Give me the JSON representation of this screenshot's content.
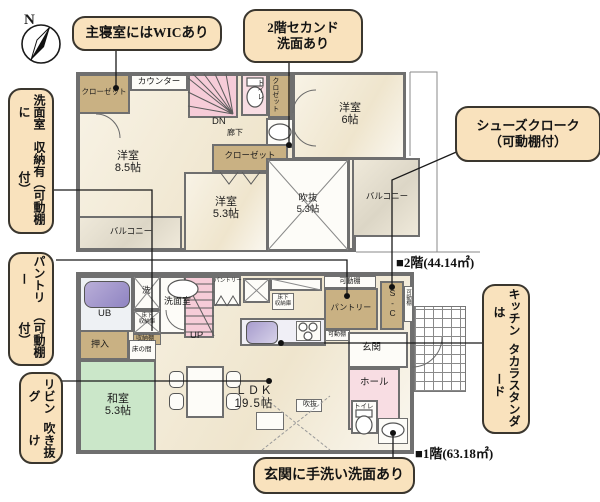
{
  "compass": {
    "north": "N"
  },
  "callouts": {
    "wic": "主寝室にはWICあり",
    "second_wash_1": "2階セカンド",
    "second_wash_2": "洗面あり",
    "washroom_storage_1": "洗面室に",
    "washroom_storage_2": "収納有（可動棚付）",
    "shoes_1": "シューズクローク",
    "shoes_2": "（可動棚付）",
    "pantry_1": "パントリー",
    "pantry_2": "（可動棚付）",
    "living_void_1": "リビング",
    "living_void_2": "吹き抜け",
    "kitchen_1": "キッチンは",
    "kitchen_2": "タカラスタンダード",
    "entrance_wash": "玄関に手洗い洗面あり"
  },
  "areas": {
    "f2": "■2階(44.14㎡)",
    "f1": "■1階(63.18㎡)"
  },
  "f2": {
    "closet": "クローゼット",
    "counter": "カウンター",
    "dn": "DN",
    "corridor": "廊下",
    "toilet": "トイレ",
    "closet_small": "クロゼット",
    "room6_1": "洋室",
    "room6_2": "6帖",
    "room85_1": "洋室",
    "room85_2": "8.5帖",
    "closet2": "クローゼット",
    "room53_1": "洋室",
    "room53_2": "5.3帖",
    "void_1": "吹抜",
    "void_2": "5.3帖",
    "balcony_l": "バルコニー",
    "balcony_r": "バルコニー"
  },
  "f1": {
    "ub": "UB",
    "laundry": "洗",
    "washroom": "洗面室",
    "underfloor_a_1": "床下",
    "underfloor_a_2": "収納庫",
    "shelf": "収納棚",
    "up": "UP",
    "pantry_small": "パントリー",
    "underfloor_b_1": "床下",
    "underfloor_b_2": "収納庫",
    "shelf_top": "可動棚",
    "pantry_room": "パントリー",
    "shelf_bottom": "可動棚",
    "sc": "S-C",
    "shelf_side": "可動棚",
    "genkan": "玄関",
    "hall": "ホール",
    "toilet": "トイレ",
    "oshiire": "押入",
    "tokonoma": "床の間",
    "washitsu_1": "和室",
    "washitsu_2": "5.3帖",
    "ldk_1": "ＬＤＫ",
    "ldk_2": "19.5帖",
    "void": "吹抜"
  },
  "colors": {
    "callout_bg": "#f9e2bd",
    "callout_border": "#3a362e",
    "closet_tan": "#c9b183",
    "stair_pink": "#f6ccd8",
    "tatami_green": "#cbe7c9",
    "balcony_gray": "#e7e2d3",
    "wall_gray": "#6f6f6f"
  }
}
